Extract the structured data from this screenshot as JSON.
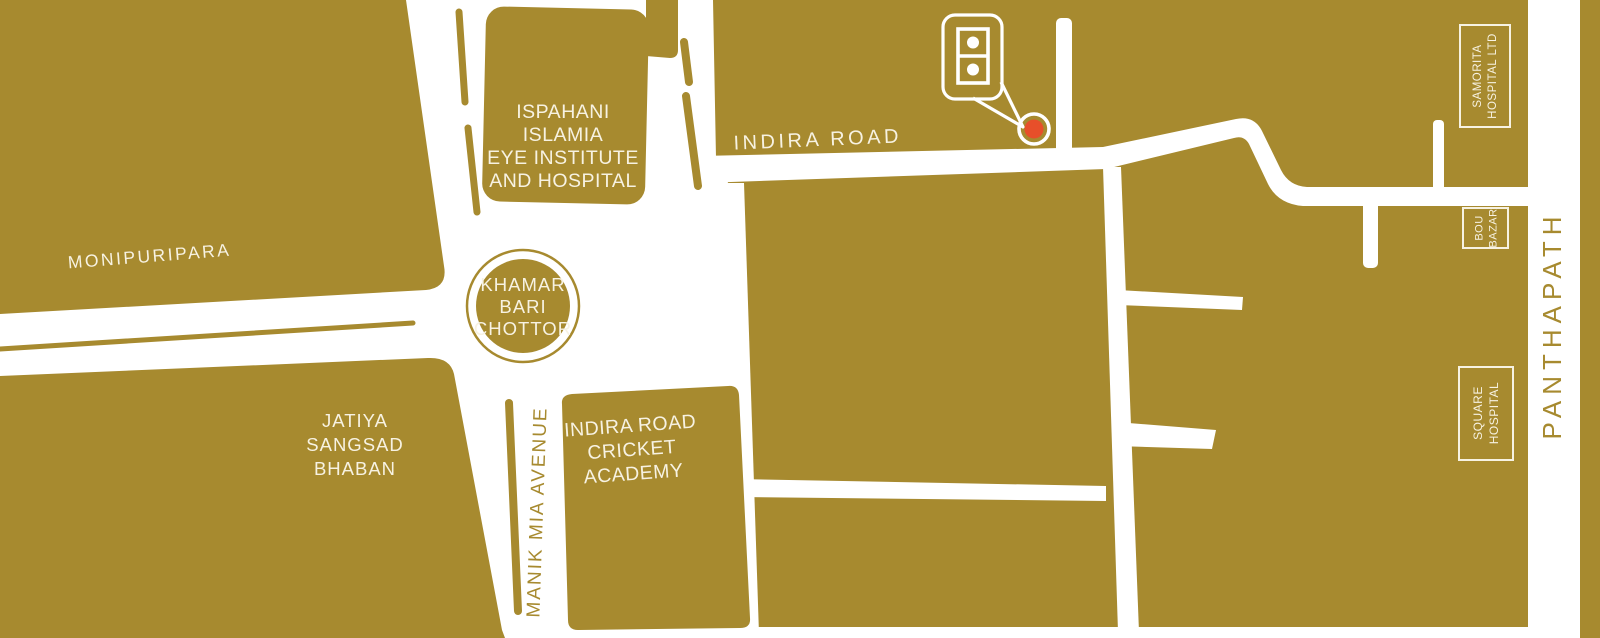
{
  "map": {
    "colors": {
      "block_gold": "#a78a2f",
      "road_white": "#ffffff",
      "label_cream": "#f7f2e2",
      "marker_orange": "#e74f2a"
    },
    "areas": {
      "monipuripara": "MONIPURIPARA",
      "ispahani_islamia": [
        "ISPAHANI",
        "ISLAMIA",
        "EYE INSTITUTE",
        "AND HOSPITAL"
      ],
      "jatiya_sangsad_bhaban": [
        "JATIYA",
        "SANGSAD",
        "BHABAN"
      ],
      "cricket_academy": [
        "INDIRA ROAD",
        "CRICKET",
        "ACADEMY"
      ]
    },
    "roads": {
      "indira_road": "INDIRA  ROAD",
      "manik_mia_avenue": "MANIK MIA AVENUE",
      "panthapath": "PANTHAPATH"
    },
    "junction": {
      "khamar_bari_chottor": [
        "KHAMAR",
        "BARI",
        "CHOTTOR"
      ]
    },
    "places": {
      "samorita_hospital": [
        "SAMORITA",
        "HOSPITAL LTD"
      ],
      "bou_bazar": [
        "BOU",
        "BAZAR"
      ],
      "square_hospital": [
        "SQUARE",
        "HOSPITAL"
      ]
    },
    "icons": {
      "building_marker": "building-with-two-windows-callout",
      "location_dot": "orange-target-dot"
    }
  }
}
